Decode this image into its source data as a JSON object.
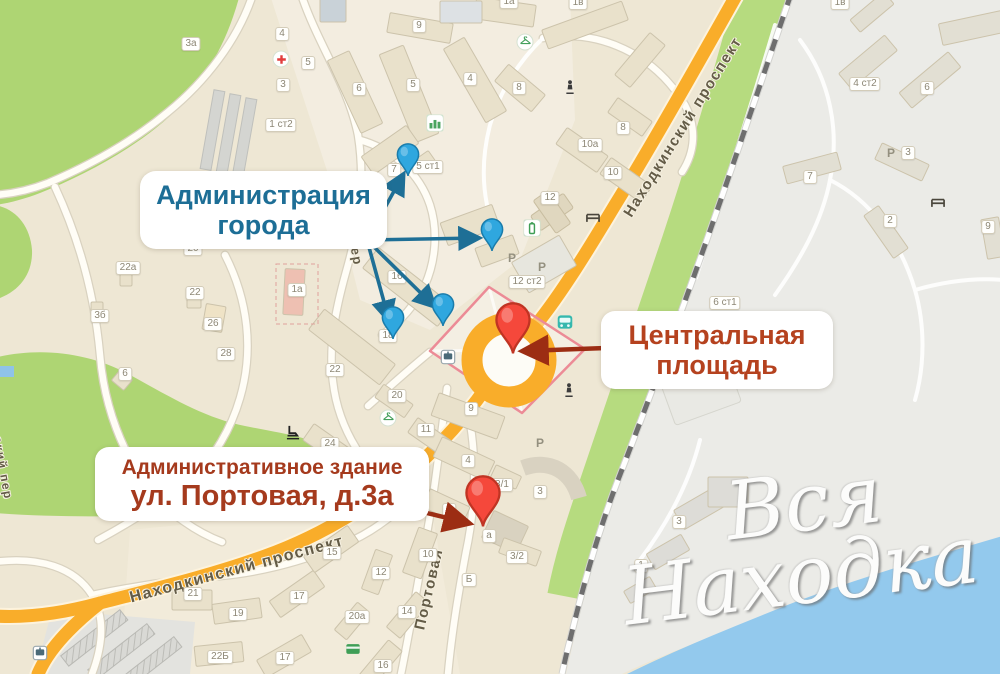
{
  "annotations": {
    "admin": {
      "line1": "Администрация",
      "line2": "города",
      "color": "#1d6e96"
    },
    "central_square": {
      "line1": "Центральная",
      "line2": "площадь",
      "color": "#b5421f"
    },
    "portovaya": {
      "line1": "Административное здание",
      "line2": "ул. Портовая, д.3а",
      "color": "#a53a1d"
    }
  },
  "watermark": {
    "line1": "Вся",
    "line2": "Находка"
  },
  "streets": [
    {
      "name": "Находкинский проспект",
      "x": 683,
      "y": 127,
      "rot": -58,
      "size": 15
    },
    {
      "name": "Находкинский проспект",
      "x": 237,
      "y": 570,
      "rot": -15,
      "size": 16
    },
    {
      "name": "Портовая",
      "x": 429,
      "y": 589,
      "rot": -77,
      "size": 15
    },
    {
      "name": "пер",
      "x": 356,
      "y": 252,
      "rot": 80,
      "size": 13
    },
    {
      "name": "ский пер",
      "x": 3,
      "y": 468,
      "rot": 80,
      "size": 12
    }
  ],
  "building_badges": [
    {
      "label": "9",
      "x": 419,
      "y": 26
    },
    {
      "label": "1а",
      "x": 509,
      "y": 2
    },
    {
      "label": "1в",
      "x": 578,
      "y": 3
    },
    {
      "label": "1в",
      "x": 840,
      "y": 3
    },
    {
      "label": "5",
      "x": 308,
      "y": 63
    },
    {
      "label": "4",
      "x": 282,
      "y": 34
    },
    {
      "label": "3",
      "x": 283,
      "y": 85
    },
    {
      "label": "1 ст2",
      "x": 281,
      "y": 125
    },
    {
      "label": "3а",
      "x": 191,
      "y": 44
    },
    {
      "label": "6",
      "x": 359,
      "y": 89
    },
    {
      "label": "5",
      "x": 413,
      "y": 85
    },
    {
      "label": "4",
      "x": 470,
      "y": 79
    },
    {
      "label": "8",
      "x": 519,
      "y": 88
    },
    {
      "label": "7",
      "x": 394,
      "y": 170
    },
    {
      "label": "5 ст1",
      "x": 428,
      "y": 167
    },
    {
      "label": "10а",
      "x": 590,
      "y": 145
    },
    {
      "label": "8",
      "x": 623,
      "y": 128
    },
    {
      "label": "10",
      "x": 613,
      "y": 173
    },
    {
      "label": "12",
      "x": 550,
      "y": 198
    },
    {
      "label": "12 ст2",
      "x": 527,
      "y": 282
    },
    {
      "label": "6 ст1",
      "x": 725,
      "y": 303
    },
    {
      "label": "4 ст2",
      "x": 865,
      "y": 84
    },
    {
      "label": "6",
      "x": 927,
      "y": 88
    },
    {
      "label": "3",
      "x": 908,
      "y": 153
    },
    {
      "label": "7",
      "x": 810,
      "y": 177
    },
    {
      "label": "2",
      "x": 890,
      "y": 221
    },
    {
      "label": "9",
      "x": 988,
      "y": 227
    },
    {
      "label": "20",
      "x": 193,
      "y": 249
    },
    {
      "label": "22а",
      "x": 128,
      "y": 268
    },
    {
      "label": "22",
      "x": 195,
      "y": 293
    },
    {
      "label": "3б",
      "x": 100,
      "y": 316
    },
    {
      "label": "26",
      "x": 213,
      "y": 324
    },
    {
      "label": "28",
      "x": 226,
      "y": 354
    },
    {
      "label": "6",
      "x": 125,
      "y": 374
    },
    {
      "label": "1а",
      "x": 297,
      "y": 290
    },
    {
      "label": "16",
      "x": 397,
      "y": 277
    },
    {
      "label": "18",
      "x": 388,
      "y": 336
    },
    {
      "label": "22",
      "x": 335,
      "y": 370
    },
    {
      "label": "20",
      "x": 397,
      "y": 396
    },
    {
      "label": "24",
      "x": 330,
      "y": 444
    },
    {
      "label": "11",
      "x": 426,
      "y": 430
    },
    {
      "label": "9",
      "x": 471,
      "y": 409
    },
    {
      "label": "4",
      "x": 468,
      "y": 461
    },
    {
      "label": "8",
      "x": 449,
      "y": 510
    },
    {
      "label": "а",
      "x": 489,
      "y": 536
    },
    {
      "label": "3/1",
      "x": 502,
      "y": 485
    },
    {
      "label": "3",
      "x": 540,
      "y": 492
    },
    {
      "label": "3/2",
      "x": 517,
      "y": 557
    },
    {
      "label": "10",
      "x": 428,
      "y": 555
    },
    {
      "label": "12",
      "x": 381,
      "y": 573
    },
    {
      "label": "14",
      "x": 407,
      "y": 612
    },
    {
      "label": "15",
      "x": 332,
      "y": 553
    },
    {
      "label": "17",
      "x": 299,
      "y": 597
    },
    {
      "label": "19",
      "x": 238,
      "y": 614
    },
    {
      "label": "21",
      "x": 193,
      "y": 594
    },
    {
      "label": "20а",
      "x": 357,
      "y": 617
    },
    {
      "label": "22Б",
      "x": 220,
      "y": 657
    },
    {
      "label": "17",
      "x": 285,
      "y": 658
    },
    {
      "label": "16",
      "x": 383,
      "y": 666
    },
    {
      "label": "Б",
      "x": 469,
      "y": 580
    },
    {
      "label": "3",
      "x": 679,
      "y": 522
    },
    {
      "label": "1",
      "x": 641,
      "y": 566
    }
  ],
  "parking_labels": [
    {
      "label": "P",
      "x": 512,
      "y": 258
    },
    {
      "label": "P",
      "x": 542,
      "y": 267
    },
    {
      "label": "P",
      "x": 704,
      "y": 385
    },
    {
      "label": "P",
      "x": 540,
      "y": 443
    },
    {
      "label": "Р",
      "x": 891,
      "y": 153
    }
  ],
  "icons": [
    {
      "type": "medical-cross-icon",
      "x": 281,
      "y": 59
    },
    {
      "type": "clothes-hanger-icon",
      "x": 525,
      "y": 42
    },
    {
      "type": "clothes-hanger-icon",
      "x": 388,
      "y": 418
    },
    {
      "type": "bar-chart-icon",
      "x": 435,
      "y": 123
    },
    {
      "type": "government-building-icon",
      "x": 532,
      "y": 228
    },
    {
      "type": "bus-icon",
      "x": 565,
      "y": 322
    },
    {
      "type": "bus-stop-icon",
      "x": 448,
      "y": 357
    },
    {
      "type": "bus-stop-icon",
      "x": 40,
      "y": 653
    },
    {
      "type": "bench-icon",
      "x": 593,
      "y": 217
    },
    {
      "type": "bench-icon",
      "x": 938,
      "y": 202
    },
    {
      "type": "monument-icon",
      "x": 569,
      "y": 390
    },
    {
      "type": "monument-icon",
      "x": 570,
      "y": 87
    },
    {
      "type": "ice-skate-icon",
      "x": 293,
      "y": 432
    },
    {
      "type": "atm-icon",
      "x": 353,
      "y": 649
    }
  ],
  "pins": [
    {
      "name": "city-administration-pin",
      "color": "blue",
      "x": 408,
      "y": 177
    },
    {
      "name": "city-administration-pin",
      "color": "blue",
      "x": 492,
      "y": 252
    },
    {
      "name": "city-administration-pin",
      "color": "blue",
      "x": 443,
      "y": 327
    },
    {
      "name": "city-administration-pin",
      "color": "blue",
      "x": 393,
      "y": 340
    },
    {
      "name": "central-square-pin",
      "color": "red",
      "x": 513,
      "y": 355
    },
    {
      "name": "portovaya-3a-pin",
      "color": "red",
      "x": 483,
      "y": 528
    }
  ],
  "colors": {
    "blue_pin": "#2fa7df",
    "red_pin": "#f5483b",
    "arrow_blue": "#1e6f96",
    "arrow_red": "#9c2d13",
    "road_orange": "#f9ad2a",
    "park_green": "#aed573",
    "water_blue": "#93c9ed",
    "square_outline_pink": "#ec8b96"
  }
}
